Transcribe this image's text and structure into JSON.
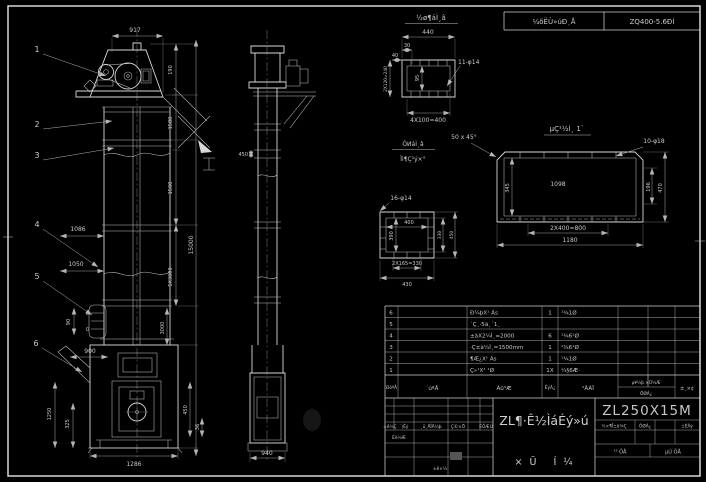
{
  "drawing": {
    "header_bar": {
      "col1": "¼õËÙ»úÐͺÅ",
      "col2": "ZQ400-5.6ÐÍ"
    },
    "front_view": {
      "balloons": [
        "1",
        "2",
        "3",
        "4",
        "5",
        "6"
      ],
      "dims": {
        "top": "917",
        "head": "190",
        "head2": "1580",
        "section": "1500",
        "total": "15000",
        "mid": "5X3000",
        "boot": "3000",
        "sp1": "1086",
        "sp2": "1050",
        "door": "90",
        "inlet": "900",
        "b1": "1250",
        "b2": "325",
        "bottom": "1286",
        "r1": "450",
        "r2": "36"
      }
    },
    "side_view": {
      "dims": {
        "flange": "450",
        "bottom": "940"
      }
    },
    "detail_top": {
      "title": "½ø¶áÌ¸â",
      "dims": {
        "w": "440",
        "off": "30",
        "off2": "40",
        "left": "2X120=240",
        "inner": "95",
        "holes": "11-φ14",
        "bottom": "4X100=400"
      }
    },
    "detail_long": {
      "title": "µÇ¹½Ì¸ 1`",
      "dims": {
        "chamfer": "50 x 45°",
        "holes": "10-φ18",
        "inner": "1098",
        "left": "345",
        "right1": "196",
        "right2": "470",
        "bottom1": "2X400=800",
        "bottom2": "1180"
      }
    },
    "detail_square": {
      "title1": "ÓͶáÌ¸â",
      "title2": "Ïì¶Ç¹ý×°",
      "dims": {
        "holes": "16-φ14",
        "w": "400",
        "h": "390",
        "right1": "330",
        "right2": "450",
        "bottom1": "2X165=330",
        "bottom2": "430"
      }
    },
    "parts_table": {
      "headers": {
        "no": "ÐòºÅ",
        "code": "´úºÅ",
        "name": "Ãû³Æ",
        "qty": "ÊýÁ¿",
        "mat": "²ÄÁÏ",
        "w1": "µ¥¼þ ×Ü¼Æ",
        "w2": "ÖØÁ¿",
        "note": "±¸×¢"
      },
      "rows": [
        {
          "no": "6",
          "code": "",
          "name": "Ð¼þX¹ Ás",
          "qty": "1",
          "mat": "¹¾1Ø"
        },
        {
          "no": "5",
          "code": "",
          "name": "´Ç¸·5ã¸´1¸",
          "qty": "",
          "mat": ""
        },
        {
          "no": "4",
          "code": "",
          "name": "±àX2¼Ì¸=2000",
          "qty": "6",
          "mat": "¹¾6¹Ø"
        },
        {
          "no": "3",
          "code": "",
          "name": "·Ç±à¼Ì¸=1500mm",
          "qty": "1",
          "mat": "¹¾6¹Ø"
        },
        {
          "no": "2",
          "code": "",
          "name": "¶Æ¿X¹ Ás",
          "qty": "1",
          "mat": "¹¾1Ø"
        },
        {
          "no": "1",
          "code": "",
          "name": "Ç»¹X¹ ¹Ø",
          "qty": "1X",
          "mat": "¼§6Æ·"
        }
      ]
    },
    "title_block": {
      "product": "ZL¶·Ê½ÌáÉý»ú",
      "drawing_type": "×Ü Í¼",
      "model": "ZL250X15M",
      "rev_labels": {
        "l1": "±ê¼Ç",
        "l2": "´¦Êý",
        "l3": "¸ü¸ÄÎÄ¼þ",
        "l4": "Ç©×Ö",
        "l5": "ÈÕÆÚ"
      },
      "rev_design": "Éè¼Æ",
      "rev_std": "±ê×¼",
      "spec_labels": {
        "s1": "½×¶Î±ê¼Ç",
        "s2": "ÖØÁ¿",
        "s3": "±ÈÀý"
      },
      "sheet_left": "¹² ÕÅ",
      "sheet_right": "µÚ ÕÅ"
    }
  }
}
